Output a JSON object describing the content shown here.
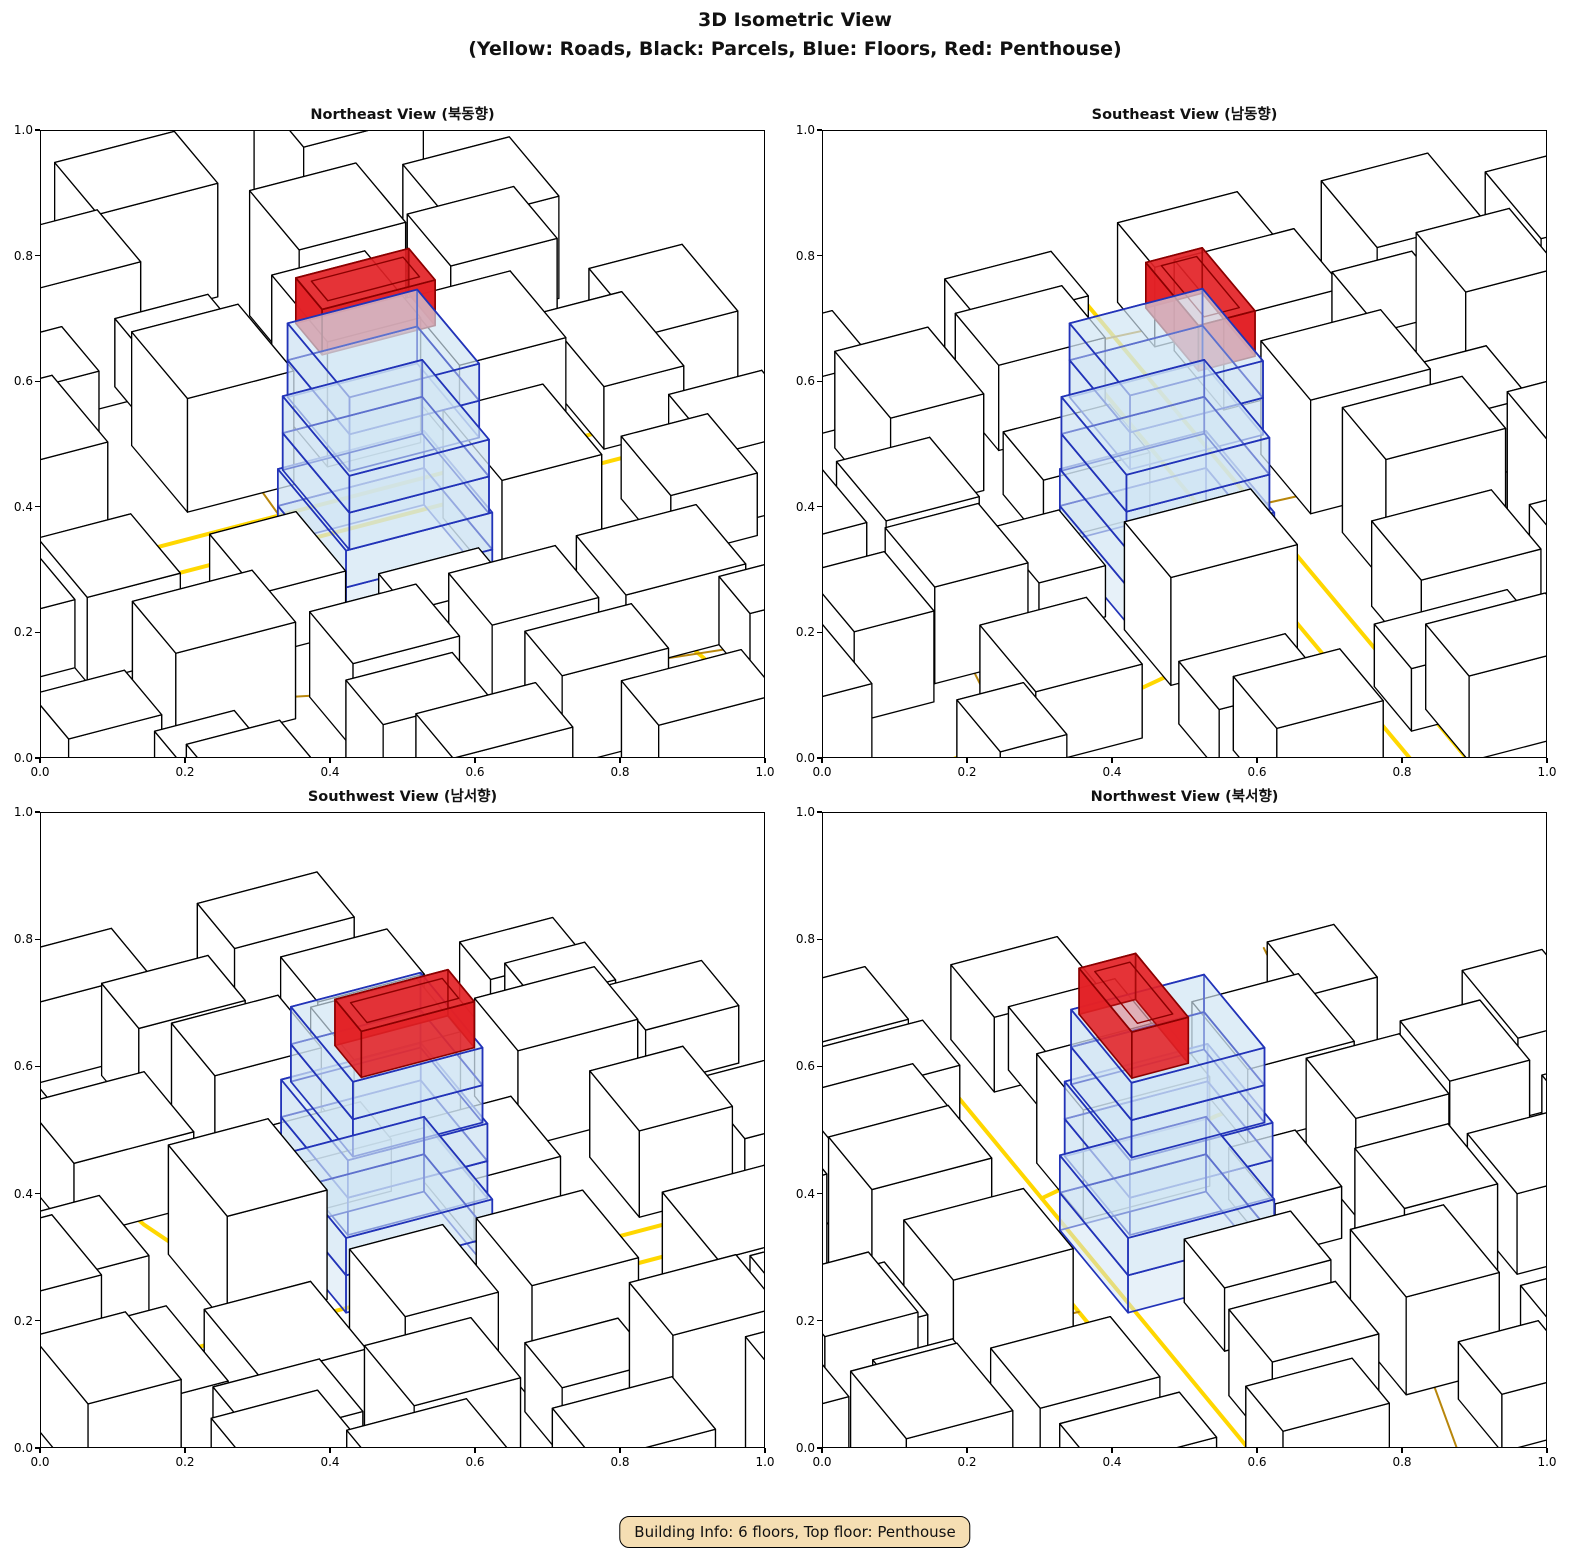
{
  "figure": {
    "title_line1": "3D Isometric View",
    "title_line2": "(Yellow: Roads, Black: Parcels, Blue: Floors, Red: Penthouse)"
  },
  "footer": {
    "badge": "Building Info: 6 floors, Top floor: Penthouse"
  },
  "colors": {
    "road": "#FFD700",
    "road_minor": "#B8860B",
    "parcel_fill": "#FFFFFF",
    "parcel_edge": "#000000",
    "floor_fill": "#CFE4F4",
    "floor_edge": "#2233B8",
    "penthouse_fill": "#E32125",
    "penthouse_edge": "#8B0000",
    "badge_bg": "#F5DEB3"
  },
  "axes": {
    "x_ticks": [
      "0.0",
      "0.2",
      "0.4",
      "0.6",
      "0.8",
      "1.0"
    ],
    "y_ticks": [
      "0.0",
      "0.2",
      "0.4",
      "0.6",
      "0.8",
      "1.0"
    ],
    "xlim": [
      0.0,
      1.0
    ],
    "ylim": [
      0.0,
      1.0
    ]
  },
  "chart_data": {
    "type": "3d-isometric-city",
    "title": "3D Isometric View",
    "subtitle": "(Yellow: Roads, Black: Parcels, Blue: Floors, Red: Penthouse)",
    "legend": {
      "yellow": "Roads",
      "black": "Parcels",
      "blue": "Floors",
      "red": "Penthouse"
    },
    "building_info": {
      "floors": 6,
      "top_floor": "Penthouse"
    },
    "views": [
      {
        "id": "northeast",
        "title": "Northeast View (북동향)",
        "azimuth": 0
      },
      {
        "id": "southeast",
        "title": "Southeast View (남동향)",
        "azimuth": 270
      },
      {
        "id": "southwest",
        "title": "Southwest View (남서향)",
        "azimuth": 180
      },
      {
        "id": "northwest",
        "title": "Northwest View (북서향)",
        "azimuth": 90
      }
    ],
    "scene": {
      "grid_skew": -20,
      "kx": 5.2,
      "ky": 2.9,
      "kz": 5.7,
      "anchor": [
        51,
        45
      ],
      "screen_anchor": [
        345,
        435
      ],
      "roads": [
        {
          "major": true,
          "pts": [
            [
              -15,
              62
            ],
            [
              115,
              62
            ]
          ]
        },
        {
          "major": true,
          "pts": [
            [
              -15,
              55
            ],
            [
              115,
              55
            ]
          ]
        },
        {
          "major": true,
          "pts": [
            [
              70,
              55
            ],
            [
              78,
              25
            ],
            [
              85,
              -24
            ]
          ]
        },
        {
          "major": false,
          "pts": [
            [
              36,
              128
            ],
            [
              44,
              80
            ],
            [
              43,
              62
            ]
          ]
        },
        {
          "major": false,
          "pts": [
            [
              -12,
              30
            ],
            [
              26,
              21
            ],
            [
              52,
              12
            ],
            [
              112,
              2
            ]
          ]
        },
        {
          "major": false,
          "pts": [
            [
              -14,
              92
            ],
            [
              -2,
              70
            ],
            [
              -4,
              40
            ]
          ]
        }
      ],
      "buildings": [
        {
          "x": 4,
          "y": 68,
          "w": 16,
          "d": 18,
          "h": 16
        },
        {
          "x": 12,
          "y": 88,
          "w": 16,
          "d": 12,
          "h": 13
        },
        {
          "x": 32,
          "y": 68,
          "w": 16,
          "d": 18,
          "h": 20
        },
        {
          "x": 36,
          "y": 88,
          "w": 14,
          "d": 12,
          "h": 12
        },
        {
          "x": 54,
          "y": 70,
          "w": 14,
          "d": 18,
          "h": 22
        },
        {
          "x": 72,
          "y": 66,
          "w": 16,
          "d": 18,
          "h": 15
        },
        {
          "x": 80,
          "y": 86,
          "w": 16,
          "d": 14,
          "h": 17
        },
        {
          "x": 90,
          "y": 58,
          "w": 12,
          "d": 20,
          "h": 11
        },
        {
          "x": 0,
          "y": 92,
          "w": 18,
          "d": 16,
          "h": 20
        },
        {
          "x": 22,
          "y": 96,
          "w": 16,
          "d": 14,
          "h": 24
        },
        {
          "x": 60,
          "y": 92,
          "w": 16,
          "d": 16,
          "h": 22
        },
        {
          "x": 84,
          "y": 94,
          "w": 16,
          "d": 16,
          "h": 18
        },
        {
          "x": 10,
          "y": 112,
          "w": 18,
          "d": 16,
          "h": 22
        },
        {
          "x": 40,
          "y": 114,
          "w": 18,
          "d": 14,
          "h": 20
        },
        {
          "x": 70,
          "y": 112,
          "w": 18,
          "d": 16,
          "h": 24
        },
        {
          "x": 2,
          "y": 36,
          "w": 14,
          "d": 16,
          "h": 15
        },
        {
          "x": 6,
          "y": 16,
          "w": 18,
          "d": 14,
          "h": 17
        },
        {
          "x": 26,
          "y": 32,
          "w": 13,
          "d": 16,
          "h": 11
        },
        {
          "x": 63,
          "y": 33,
          "w": 15,
          "d": 19,
          "h": 19
        },
        {
          "x": 28,
          "y": 6,
          "w": 16,
          "d": 14,
          "h": 15
        },
        {
          "x": 48,
          "y": 4,
          "w": 16,
          "d": 14,
          "h": 17
        },
        {
          "x": 70,
          "y": 8,
          "w": 18,
          "d": 16,
          "h": 13
        },
        {
          "x": 87,
          "y": 30,
          "w": 13,
          "d": 16,
          "h": 11
        },
        {
          "x": 44,
          "y": 22,
          "w": 15,
          "d": 10,
          "h": 9
        },
        {
          "x": 0,
          "y": 0,
          "w": 12,
          "d": 10,
          "h": 9
        },
        {
          "x": 84,
          "y": -2,
          "w": 14,
          "d": 10,
          "h": 12
        },
        {
          "x": 26,
          "y": -8,
          "w": 16,
          "d": 12,
          "h": 14
        },
        {
          "x": 52,
          "y": -10,
          "w": 16,
          "d": 12,
          "h": 16
        },
        {
          "x": 2,
          "y": -6,
          "w": 14,
          "d": 10,
          "h": 10
        },
        {
          "x": 30,
          "y": -22,
          "w": 18,
          "d": 12,
          "h": 16
        },
        {
          "x": 60,
          "y": -24,
          "w": 18,
          "d": 12,
          "h": 14
        },
        {
          "x": 96,
          "y": 34,
          "w": 14,
          "d": 16,
          "h": 13
        },
        {
          "x": 98,
          "y": 62,
          "w": 14,
          "d": 18,
          "h": 15
        },
        {
          "x": -10,
          "y": 40,
          "w": 12,
          "d": 16,
          "h": 12
        },
        {
          "x": -12,
          "y": 12,
          "w": 14,
          "d": 12,
          "h": 10
        },
        {
          "x": -10,
          "y": 66,
          "w": 12,
          "d": 18,
          "h": 14
        }
      ],
      "target": {
        "floor_height": 6.5,
        "floors": [
          {
            "x": 40,
            "y": 34,
            "w": 22,
            "d": 22
          },
          {
            "x": 40,
            "y": 34,
            "w": 22,
            "d": 22
          },
          {
            "x": 40.5,
            "y": 34,
            "w": 21,
            "d": 21.5
          },
          {
            "x": 40.5,
            "y": 34,
            "w": 21,
            "d": 21.5
          },
          {
            "x": 41,
            "y": 35,
            "w": 19.5,
            "d": 20
          },
          {
            "x": 41,
            "y": 35,
            "w": 19.5,
            "d": 20
          }
        ],
        "penthouse": {
          "x": 42,
          "y": 46,
          "w": 17,
          "d": 8.5,
          "h": 8,
          "z0": 39
        }
      }
    }
  }
}
